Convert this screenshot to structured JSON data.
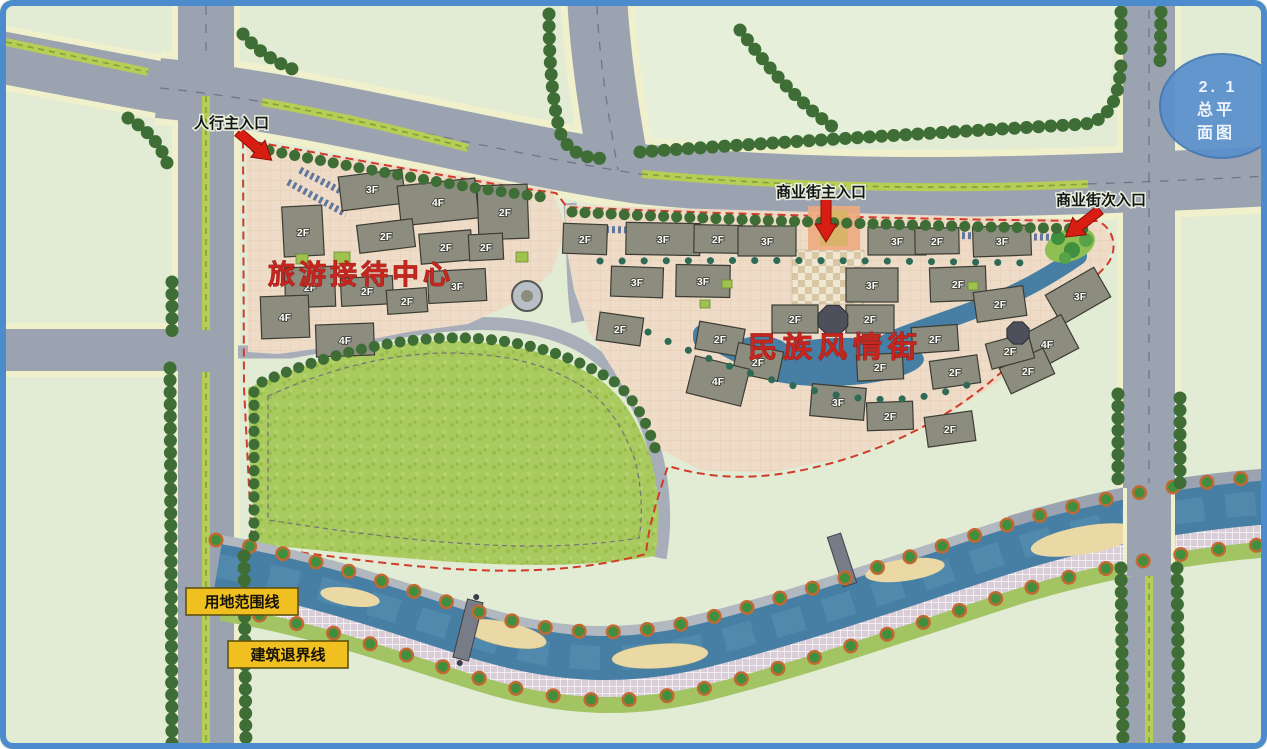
{
  "badge": {
    "line1": "2. 1",
    "line2": "总平",
    "line3": "面图"
  },
  "entrances": {
    "pedestrian_main": "人行主入口",
    "commercial_main": "商业街主入口",
    "commercial_secondary": "商业街次入口"
  },
  "zones": {
    "tourist_reception_center": "旅游接待中心",
    "folk_custom_street": "民族风情街"
  },
  "legend": {
    "land_use_boundary": "用地范围线",
    "building_setback": "建筑退界线"
  },
  "floor_labels": [
    {
      "x": 372,
      "y": 193,
      "t": "3F"
    },
    {
      "x": 438,
      "y": 206,
      "t": "4F"
    },
    {
      "x": 505,
      "y": 216,
      "t": "2F"
    },
    {
      "x": 303,
      "y": 236,
      "t": "2F"
    },
    {
      "x": 386,
      "y": 240,
      "t": "2F"
    },
    {
      "x": 446,
      "y": 251,
      "t": "2F"
    },
    {
      "x": 486,
      "y": 251,
      "t": "2F"
    },
    {
      "x": 310,
      "y": 291,
      "t": "2F"
    },
    {
      "x": 367,
      "y": 295,
      "t": "2F"
    },
    {
      "x": 457,
      "y": 290,
      "t": "3F"
    },
    {
      "x": 407,
      "y": 305,
      "t": "2F"
    },
    {
      "x": 285,
      "y": 321,
      "t": "4F"
    },
    {
      "x": 345,
      "y": 344,
      "t": "4F"
    },
    {
      "x": 585,
      "y": 243,
      "t": "2F"
    },
    {
      "x": 663,
      "y": 243,
      "t": "3F"
    },
    {
      "x": 718,
      "y": 243,
      "t": "2F"
    },
    {
      "x": 767,
      "y": 245,
      "t": "3F"
    },
    {
      "x": 897,
      "y": 245,
      "t": "3F"
    },
    {
      "x": 937,
      "y": 245,
      "t": "2F"
    },
    {
      "x": 1002,
      "y": 245,
      "t": "3F"
    },
    {
      "x": 637,
      "y": 286,
      "t": "3F"
    },
    {
      "x": 703,
      "y": 285,
      "t": "3F"
    },
    {
      "x": 872,
      "y": 289,
      "t": "3F"
    },
    {
      "x": 958,
      "y": 288,
      "t": "2F"
    },
    {
      "x": 1080,
      "y": 300,
      "t": "3F"
    },
    {
      "x": 795,
      "y": 323,
      "t": "2F"
    },
    {
      "x": 870,
      "y": 323,
      "t": "2F"
    },
    {
      "x": 1000,
      "y": 308,
      "t": "2F"
    },
    {
      "x": 935,
      "y": 343,
      "t": "2F"
    },
    {
      "x": 1047,
      "y": 348,
      "t": "4F"
    },
    {
      "x": 1028,
      "y": 375,
      "t": "2F"
    },
    {
      "x": 620,
      "y": 333,
      "t": "2F"
    },
    {
      "x": 720,
      "y": 343,
      "t": "2F"
    },
    {
      "x": 758,
      "y": 366,
      "t": "2F"
    },
    {
      "x": 718,
      "y": 385,
      "t": "4F"
    },
    {
      "x": 880,
      "y": 371,
      "t": "2F"
    },
    {
      "x": 955,
      "y": 376,
      "t": "2F"
    },
    {
      "x": 1010,
      "y": 355,
      "t": "2F"
    },
    {
      "x": 838,
      "y": 406,
      "t": "3F"
    },
    {
      "x": 890,
      "y": 420,
      "t": "2F"
    },
    {
      "x": 950,
      "y": 433,
      "t": "2F"
    }
  ],
  "colors": {
    "frame": "#4d8ccc",
    "background": "#e2ebd3",
    "road": "#9ba3b1",
    "road_edge": "#f0f0cc",
    "median": "#b6ce55",
    "tree": "#3e6e35",
    "lawn": "#a9ca5e",
    "river": "#477fa4",
    "site_ground": "#eedcc9",
    "building": "#8d8d7f",
    "boundary_red": "#d23b2a",
    "label_yellow": "#f0c020",
    "text_red": "#c4271f",
    "arrow_red": "#d81e12",
    "badge_blue": "#5a90cc"
  }
}
